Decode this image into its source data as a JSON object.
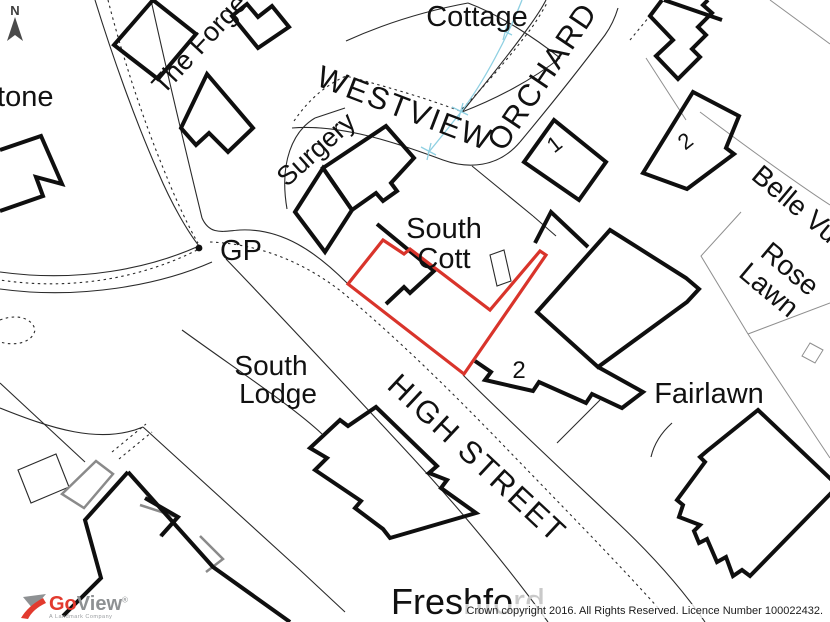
{
  "map": {
    "labels": {
      "stone": "stone",
      "the_forge": "The Forge",
      "cottage": "Cottage",
      "westview": "WESTVIEW",
      "orchard": "ORCHARD",
      "surgery": "Surgery",
      "south_cott_line1": "South",
      "south_cott_line2": "Cott",
      "gp": "GP",
      "south_lodge_line1": "South",
      "south_lodge_line2": "Lodge",
      "high_street": "HIGH STREET",
      "fairlawn": "Fairlawn",
      "belle_vue": "Belle Vue",
      "rose_lawn_line1": "Rose",
      "rose_lawn_line2": "Lawn",
      "freshford_dark": "Freshfo",
      "freshford_faded": "rd",
      "house_no_1": "1",
      "house_no_2_east": "2",
      "house_no_2_south": "2",
      "north_indicator": "N"
    },
    "colors": {
      "plot_boundary": "#d9342b",
      "water": "#8fd0e2",
      "building": "#0f0f0f",
      "faded_text": "#c9c9c9"
    }
  },
  "branding": {
    "logo_go": "Go",
    "logo_view": "View",
    "logo_reg": "®",
    "logo_tagline": "A Landmark Company"
  },
  "footer": {
    "copyright": "Crown copyright 2016. All Rights Reserved. Licence Number 100022432."
  }
}
